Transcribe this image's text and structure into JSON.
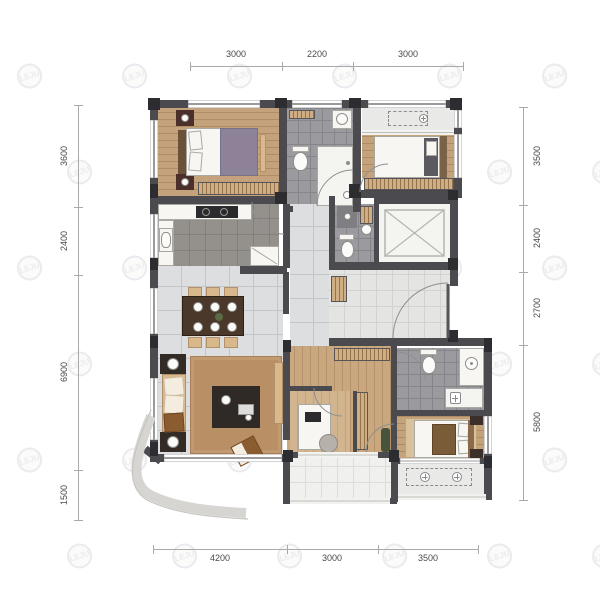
{
  "watermark": {
    "logo": "LEJU",
    "text": "乐居"
  },
  "colors": {
    "wall": "#4b4b4f",
    "wood": "#c4a27c",
    "tile": "#dcdedf",
    "bath": "#9b9a9e",
    "counter": "#f7f6f3",
    "dim": "#4a4a4a",
    "wm": "#eceaee"
  },
  "dimensions": {
    "top": [
      "3000",
      "2200",
      "3000"
    ],
    "left": [
      "3600",
      "2400",
      "6900",
      "1500"
    ],
    "right": [
      "3500",
      "2400",
      "2700",
      "5800"
    ],
    "bottom": [
      "4200",
      "3000",
      "3500"
    ]
  }
}
